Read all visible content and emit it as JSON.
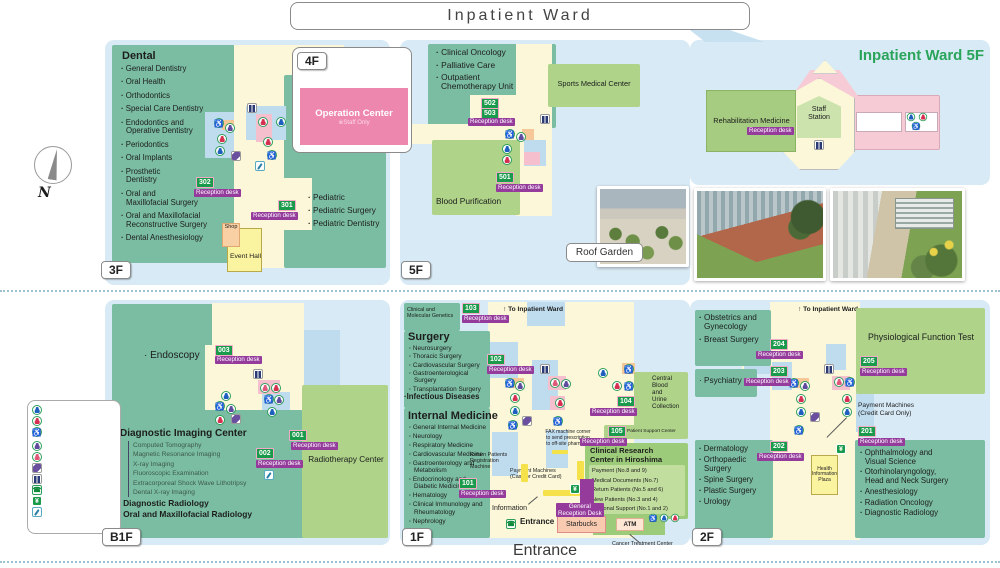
{
  "colors": {
    "panel": "#d8eaf5",
    "teal": "#7abda2",
    "lightgreen": "#aed389",
    "cream": "#fbf7d8",
    "bluepatch": "#bfdcef",
    "pink": "#ee87ae",
    "wardpink": "#f7cbd6",
    "purple": "#943b9c",
    "badge": "#1a9b4b",
    "badgeborder": "#f4a9c6",
    "title_green": "#2aa45a",
    "orange": "#f6c897",
    "yellowbar": "#f5e14a",
    "green_dark": "#2e9e5b"
  },
  "header": {
    "title": "Inpatient Ward"
  },
  "compass_label": "N",
  "reception_desk": "Reception desk",
  "to_inpatient_ward": "↑ To Inpatient Ward",
  "f3": {
    "tab": "3F",
    "heading": "Dental",
    "items": [
      "General Dentistry",
      "Oral Health",
      "Orthodontics",
      "Special Care Dentistry",
      "Endodontics and\nOperative Dentistry",
      "Periodontics",
      "Oral Implants",
      "Prosthetic\nDentistry",
      "Oral and\nMaxillofacial Surgery",
      "Oral and Maxillofacial\nReconstructive Surgery",
      "Dental Anesthesiology"
    ],
    "pediatric": [
      "Pediatric",
      "Pediatric Surgery",
      "Pediatric Dentistry"
    ],
    "rec302": "302",
    "rec301": "301",
    "shop": "Shop",
    "event_hall": "Event Hall"
  },
  "f4": {
    "tab": "4F",
    "operation_center": "Operation Center",
    "staff_only": "※Staff Only"
  },
  "f5": {
    "tab": "5F",
    "items": [
      "Clinical Oncology",
      "Palliative Care",
      "Outpatient\nChemotherapy Unit"
    ],
    "sports": "Sports Medical Center",
    "rec502": "502",
    "rec503": "503",
    "rec501": "501",
    "blood": "Blood Purification",
    "roof_garden": "Roof Garden"
  },
  "in5f": {
    "title": "Inpatient Ward 5F",
    "rehab": "Rehabilitation Medicine",
    "staff_station": "Staff\nStation"
  },
  "b1f": {
    "tab": "B1F",
    "endoscopy": "Endoscopy",
    "rec003": "003",
    "rec001": "001",
    "rec002": "002",
    "imaging_heading": "Diagnostic Imaging Center",
    "imaging_items": [
      "Computed Tomography",
      "Magnetic Resonance Imaging",
      "X-ray Imaging",
      "Fluoroscopic Examination",
      "Extracorporeal Shock Wave Lithotripsy",
      "Dental X-ray Imaging"
    ],
    "radiology_items": [
      "Diagnostic Radiology",
      "Oral and Maxillofacial Radiology"
    ],
    "radiotherapy": "Radiotherapy Center"
  },
  "f1": {
    "tab": "1F",
    "genetics": "Clinical and\nMolecular Genetics",
    "rec103": "103",
    "rec102": "102",
    "rec101": "101",
    "rec104": "104",
    "rec105": "105",
    "surgery_heading": "Surgery",
    "surgery_items": [
      "Neurosurgery",
      "Thoracic Surgery",
      "Cardiovascular Surgery",
      "Gastroenterological\nSurgery",
      "Transplantation Surgery"
    ],
    "infectious": "Infectious Diseases",
    "im_heading": "Internal Medicine",
    "im_items": [
      "General Internal Medicine",
      "Neurology",
      "Respiratory Medicine",
      "Cardiovascular Medicine",
      "Gastroenterology and\nMetabolism",
      "Endocrinology and\nDiabetic Medicine",
      "Hematology",
      "Clinical Immunology and\nRheumatology",
      "Nephrology"
    ],
    "fax_note": "FAX machine corner\nto send prescription\nto off-site pharmacy",
    "return_machine": "Return Patients\nRegistration\nMachine",
    "payment_machines": "Payment Machines\n(Cash or Credit Card)",
    "information": "Information",
    "general_reception": "General\nReception Desk",
    "central_blood": "Central\nBlood\nand\nUrine\nCollection",
    "patient_support": "Patient Support Center",
    "crc": "Clinical Research\nCenter in Hiroshima",
    "crc_items": [
      "Payment (No.8 and 9)",
      "Medical Documents (No.7)",
      "Return Patients (No.5 and 6)",
      "New Patients (No.3 and 4)",
      "Regional Support (No.1 and 2)"
    ],
    "entrance": "Entrance",
    "starbucks": "Starbucks",
    "atm": "ATM",
    "cancer_center": "Cancer Treatment Center",
    "entrance_big": "Entrance"
  },
  "f2": {
    "tab": "2F",
    "left_top": [
      "Obstetrics and\nGynecology",
      "Breast Surgery"
    ],
    "psychiatry": "Psychiatry",
    "rec204": "204",
    "rec203": "203",
    "rec205": "205",
    "rec201": "201",
    "rec202": "202",
    "physio": "Physiological Function Test",
    "payment": "Payment Machines\n(Credit Card Only)",
    "left_bottom": [
      "Dermatology",
      "Orthopaedic\nSurgery",
      "Spine Surgery",
      "Plastic Surgery",
      "Urology"
    ],
    "health_plaza": "Health\nInformation\nPlaza",
    "right_bottom": [
      "Ophthalmology and\nVisual Science",
      "Otorhinolaryngology,\nHead and Neck Surgery",
      "Anesthesiology",
      "Radiation Oncology",
      "Diagnostic Radiology"
    ]
  },
  "legend": {
    "items": [
      "Men's Room",
      "Women's Room",
      "Multipurpose\nRestroom",
      "Ostomate",
      "Nursing Room",
      "Escalator",
      "Elevator",
      "Public Phone",
      "Payment Machine",
      "A Place to brush\nyour teeth"
    ]
  }
}
